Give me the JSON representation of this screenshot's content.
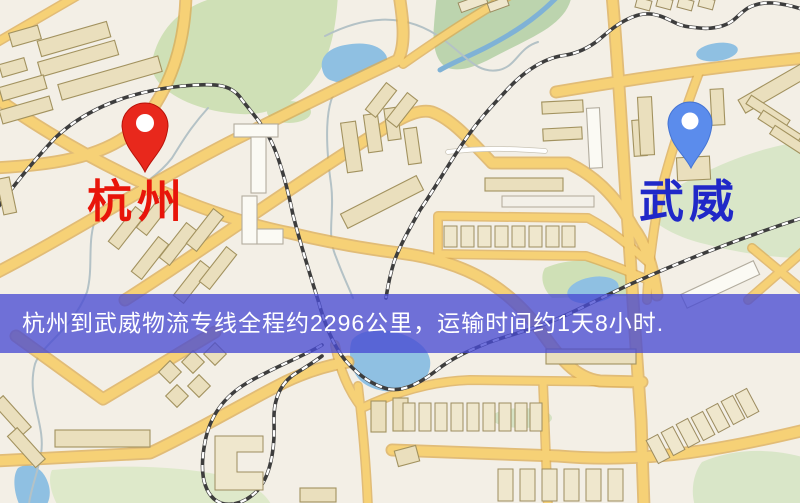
{
  "markers": {
    "origin": {
      "label": "杭州",
      "label_color": "#e8150a",
      "pin_color": "#e8281c"
    },
    "destination": {
      "label": "武威",
      "label_color": "#2028c8",
      "pin_color": "#5b8cec"
    }
  },
  "banner": {
    "text": "杭州到武威物流专线全程约2296公里，运输时间约1天8小时.",
    "bg": "#494cd2",
    "text_color": "#ffffff",
    "distance_text": "约2296公里",
    "duration_text": "约1天8小时"
  }
}
